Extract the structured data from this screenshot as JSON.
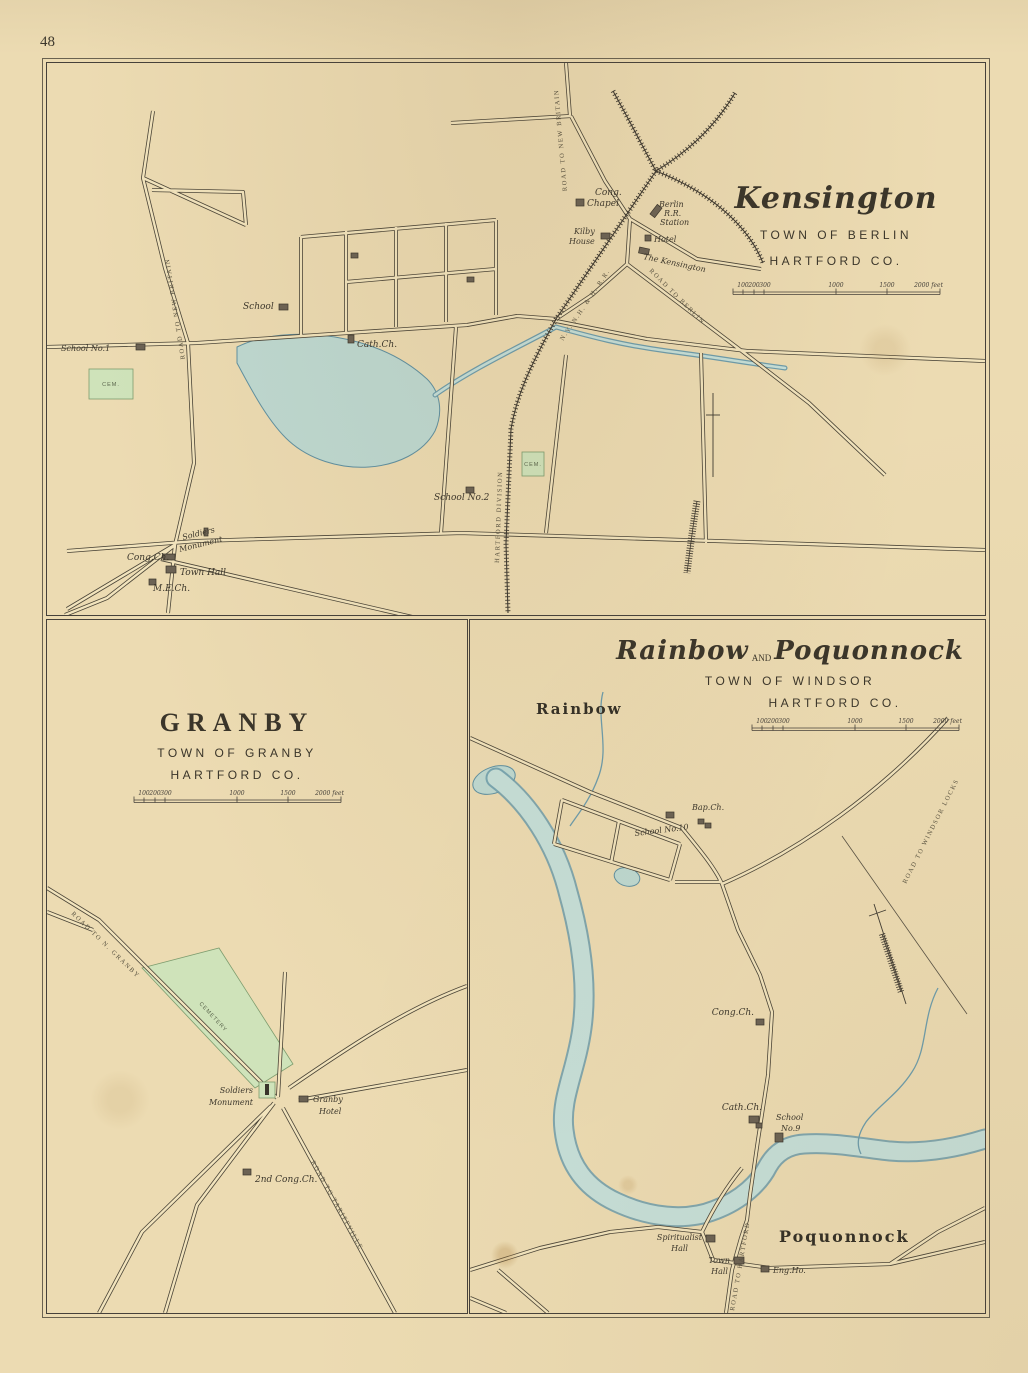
{
  "page": {
    "number": "48"
  },
  "colors": {
    "paper": "#ecdbb2",
    "ink": "#4a4437",
    "water_fill": "#c6dfd8",
    "water_edge": "#6d9cab",
    "cemetery_fill": "#cfe3ba",
    "building": "#6b6254"
  },
  "kensington": {
    "title": "Kensington",
    "town": "TOWN OF BERLIN",
    "county": "HARTFORD CO.",
    "scale": {
      "t0": "100",
      "t1": "200",
      "t2": "300",
      "t3": "1000",
      "t4": "1500",
      "end": "2000 feet"
    },
    "labels": {
      "road_to_new_britain_west": "ROAD TO NEW BRITAIN",
      "road_to_new_britain_north": "ROAD TO NEW BRITAIN",
      "road_to_berlin": "ROAD TO BERLIN",
      "railroad_division": "HARTFORD DIVISION",
      "railroad_name": "N.Y. N.H. & H. R.R.",
      "school_no1": "School No.1",
      "cem_west": "CEM.",
      "school": "School",
      "cath_ch": "Cath.Ch.",
      "cong_chapel_line1": "Cong.",
      "cong_chapel_line2": "Chapel",
      "station_line1": "Berlin",
      "station_line2": "R.R.",
      "station_line3": "Station",
      "kilby_line1": "Kilby",
      "kilby_line2": "House",
      "hotel": "Hotel",
      "the_kensington": "The Kensington",
      "school_no2": "School No.2",
      "cem_east": "CEM.",
      "soldiers_line1": "Soldiers",
      "soldiers_line2": "Monument",
      "cong_ch": "Cong.Ch.",
      "town_hall": "Town Hall",
      "me_ch": "M.E.Ch."
    }
  },
  "granby": {
    "title": "GRANBY",
    "town": "TOWN OF GRANBY",
    "county": "HARTFORD CO.",
    "scale": {
      "t0": "100",
      "t1": "200",
      "t2": "300",
      "t3": "1000",
      "t4": "1500",
      "end": "2000 feet"
    },
    "labels": {
      "road_to_n_granby": "ROAD TO N. GRANBY",
      "road_to_tariffville": "ROAD TO TARIFFVILLE",
      "cemetery": "CEMETERY",
      "soldiers_line1": "Soldiers",
      "soldiers_line2": "Monument",
      "hotel_line1": "Granby",
      "hotel_line2": "Hotel",
      "second_cong_ch": "2nd Cong.Ch."
    }
  },
  "rainbow_poquonnock": {
    "title_left": "Rainbow",
    "title_and": "AND",
    "title_right": "Poquonnock",
    "town": "TOWN OF WINDSOR",
    "county": "HARTFORD CO.",
    "scale": {
      "t0": "100",
      "t1": "200",
      "t2": "300",
      "t3": "1000",
      "t4": "1500",
      "end": "2000 feet"
    },
    "labels": {
      "rainbow": "Rainbow",
      "poquonnock": "Poquonnock",
      "road_to_windsor_locks": "ROAD TO WINDSOR LOCKS",
      "road_to_hartford": "ROAD TO HARTFORD",
      "school_no10": "School No.10",
      "bap_ch": "Bap.Ch.",
      "cong_ch": "Cong.Ch.",
      "cath_ch": "Cath.Ch.",
      "school_no9_line1": "School",
      "school_no9_line2": "No.9",
      "spiritualist_line1": "Spiritualist",
      "spiritualist_line2": "Hall",
      "town_hall_line1": "Town",
      "town_hall_line2": "Hall",
      "eng_ho": "Eng.Ho."
    }
  }
}
